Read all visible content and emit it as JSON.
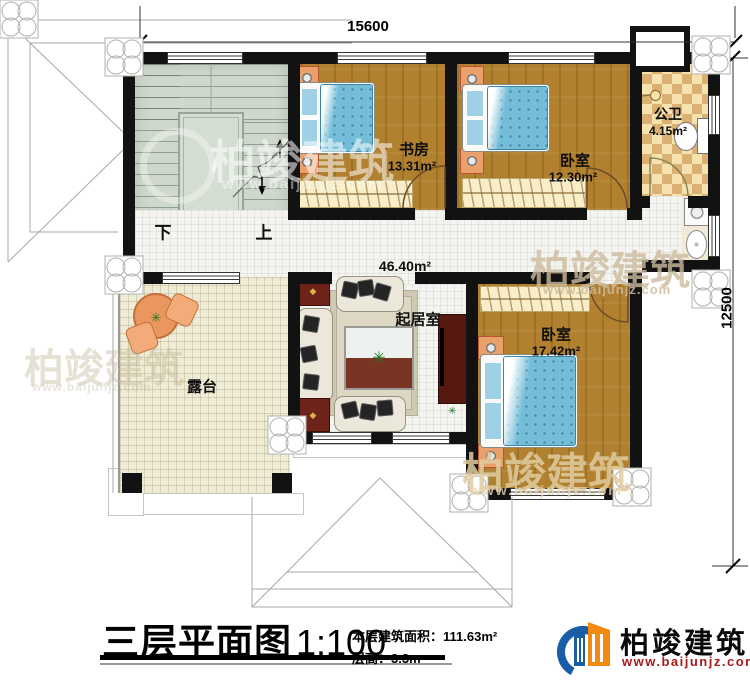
{
  "dimensions": {
    "top": "15600",
    "right": "12500"
  },
  "stairs": {
    "down": "下",
    "up": "上"
  },
  "rooms": {
    "study": {
      "name": "书房",
      "area": "13.31m²"
    },
    "bedroom_top": {
      "name": "卧室",
      "area": "12.30m²"
    },
    "bathroom": {
      "name": "公卫",
      "area": "4.15m²"
    },
    "living": {
      "name": "起居室",
      "area": "46.40m²"
    },
    "bedroom_right": {
      "name": "卧室",
      "area": "17.42m²"
    },
    "terrace": {
      "name": "露台"
    }
  },
  "footer": {
    "title": "三层平面图",
    "scale": "1:100",
    "floor_area": "本层建筑面积：111.63m²",
    "floor_height": "层高：3.3m"
  },
  "brand": {
    "name": "柏竣建筑",
    "url": "www.baijunjz.com"
  },
  "watermark": {
    "brand": "柏竣建筑",
    "url": "www.baijunjz.com"
  },
  "colors": {
    "wall": "#121212",
    "wood": "#b1812f",
    "duvet": "#74bdd9",
    "stair": "#cfd8cc",
    "tile": "#f4f4f1",
    "terrace": "#eeebd6",
    "checker_light": "#f6e2ae",
    "checker_dark": "#dab173",
    "url_red": "#a51c1c",
    "logo_blue": "#1b5ca6",
    "logo_orange": "#f28a12"
  }
}
